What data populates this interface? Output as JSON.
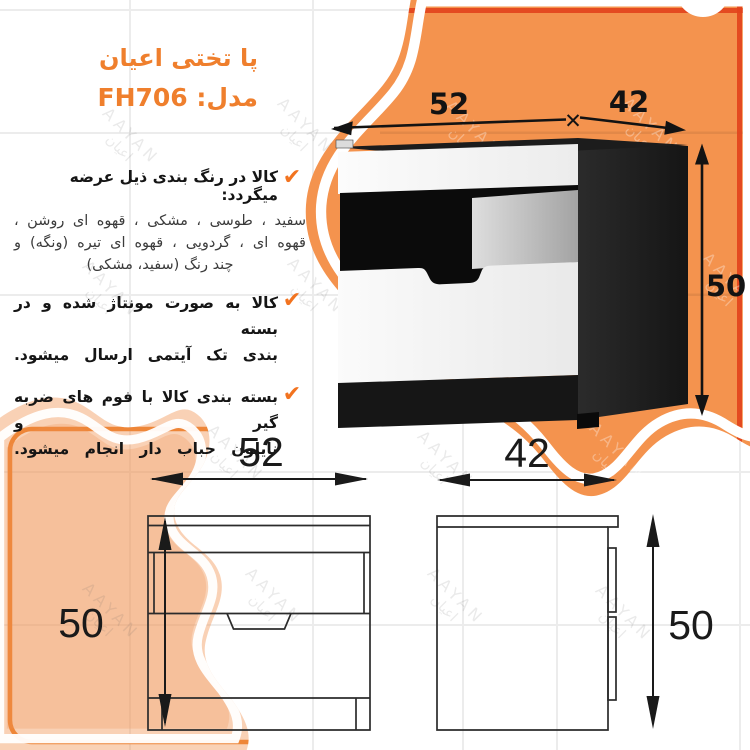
{
  "title": {
    "line1": "پا تختی  اعیان",
    "line2": "مدل:  FH706"
  },
  "icons": {
    "check": "✔",
    "dim_separator": "✕"
  },
  "bullets": [
    {
      "heading": "کالا در رنگ بندی ذیل عرضه میگردد:",
      "body_lines": [
        "سفید ، طوسی ، مشکی ، قهوه ای روشن ،",
        "قهوه ای ، گردویی ، قهوه ای تیره (ونگه) و",
        "چند رنگ (سفید، مشکی)"
      ]
    },
    {
      "lines": [
        "کالا به صورت مونتاژ شده و در بسته",
        "بندی تک آیتمی ارسال میشود."
      ]
    },
    {
      "lines": [
        "بسته بندی کالا با فوم های ضربه گیر و",
        "نایلون حباب دار انجام میشود."
      ]
    }
  ],
  "dimensions": {
    "width": "52",
    "depth": "42",
    "height": "50"
  },
  "watermark": {
    "latin": "AAYAN",
    "arabic": "اعیان"
  },
  "colors": {
    "accent_orange": "#ef7f2d",
    "blob_orange": "#f4934e",
    "peach_orange": "#f1914f",
    "stripe_red": "#e2431c",
    "check_orange": "#f2731f",
    "drawing_line": "#2b2b2b"
  }
}
